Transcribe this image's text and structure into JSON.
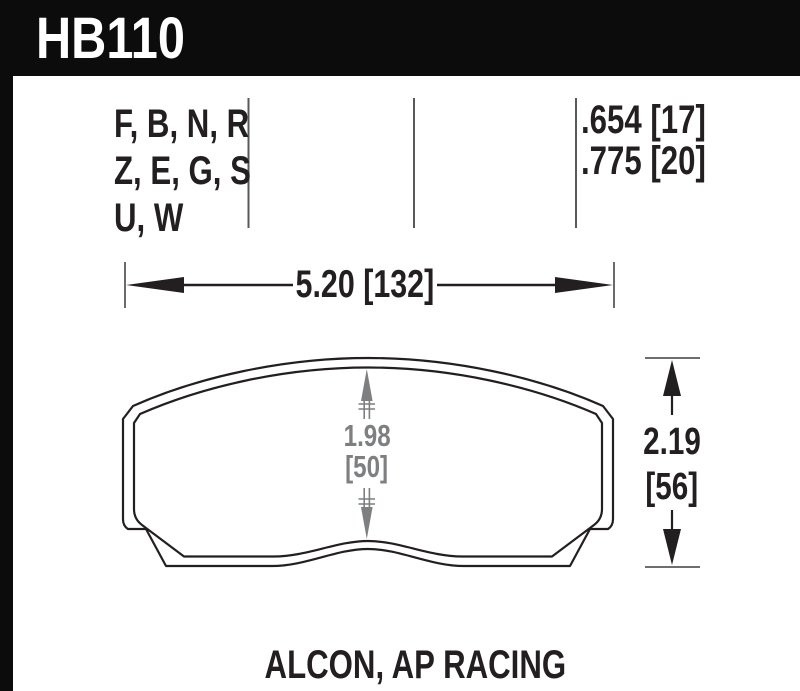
{
  "part": {
    "number": "HB110"
  },
  "spec_columns": {
    "compound_codes": {
      "line1": "F, B, N, R",
      "line2": "Z, E, G, S",
      "line3": "U, W"
    },
    "thickness": {
      "line1": ".654 [17]",
      "line2": ".775 [20]"
    }
  },
  "dimensions": {
    "overall_width": "5.20 [132]",
    "center_height_in": "1.98",
    "center_height_mm": "[50]",
    "overall_height_in": "2.19",
    "overall_height_mm": "[56]"
  },
  "footer": {
    "application": "ALCON, AP RACING"
  },
  "colors": {
    "header_bg": "#0c0c0c",
    "line_black": "#231f20",
    "secondary_gray": "#7d7f81",
    "tick_gray": "#58595b",
    "text_white": "#ffffff"
  }
}
